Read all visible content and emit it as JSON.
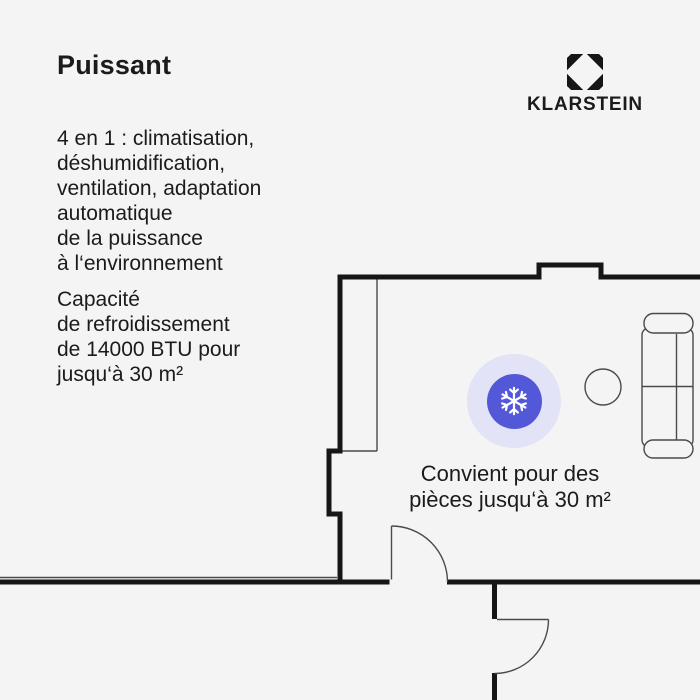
{
  "title": "Puissant",
  "brand": {
    "name": "KLARSTEIN"
  },
  "features": {
    "lines": [
      "4 en 1 : climatisation,",
      "déshumidification,",
      "ventilation, adaptation",
      "automatique",
      "de la puissance",
      "à l‘environnement"
    ]
  },
  "capacity": {
    "lines": [
      "Capacité",
      "de refroidissement",
      "de 14000 BTU pour",
      "jusqu‘à 30 m²"
    ]
  },
  "plan": {
    "caption_line1": "Convient pour des",
    "caption_line2": "pièces jusqu‘à 30 m²",
    "badge_icon": "snowflake-icon"
  },
  "colors": {
    "background": "#f4f4f4",
    "text": "#1b1b1b",
    "wall": "#161616",
    "thin_line": "#4a4a4a",
    "accent": "#5358d8",
    "halo": "#e2e3f6",
    "snowflake": "#ffffff"
  }
}
